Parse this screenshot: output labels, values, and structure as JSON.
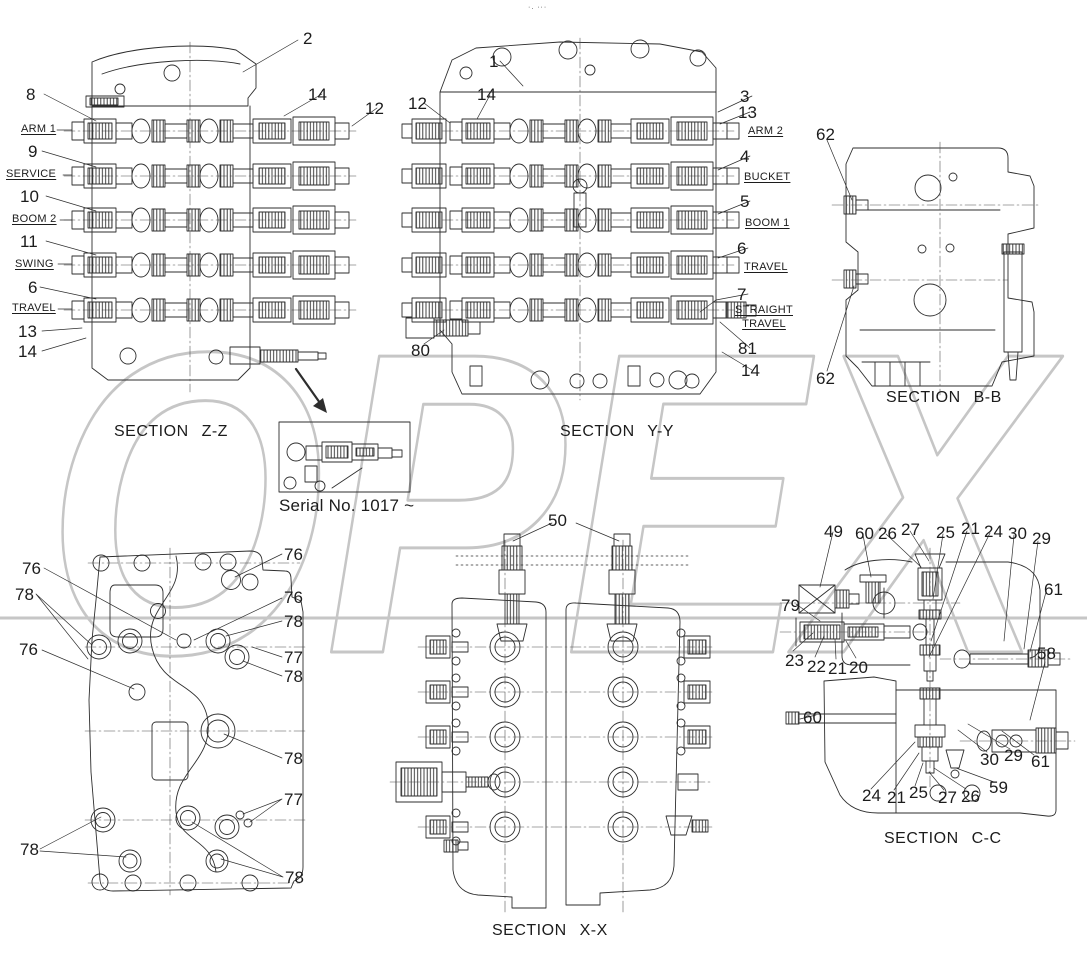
{
  "page": {
    "background": "#ffffff",
    "top_marks": "·. ···"
  },
  "watermark": {
    "text": "OPEX",
    "color": "#c6c6c6"
  },
  "diagram": {
    "sections": [
      {
        "id": "section-zz",
        "title": "SECTION Z-Z",
        "ports": [
          "ARM 1",
          "SERVICE",
          "BOOM 2",
          "SWING",
          "TRAVEL"
        ],
        "callouts": [
          "2",
          "8",
          "9",
          "10",
          "11",
          "6",
          "13",
          "14",
          "12"
        ]
      },
      {
        "id": "section-yy",
        "title": "SECTION Y-Y",
        "ports": [
          "ARM 2",
          "BUCKET",
          "BOOM 1",
          "TRAVEL",
          "STRAIGHT TRAVEL"
        ],
        "callouts": [
          "1",
          "12",
          "14",
          "3",
          "13",
          "4",
          "5",
          "6",
          "7",
          "80",
          "81"
        ]
      },
      {
        "id": "section-bb",
        "title": "SECTION B-B",
        "callouts": [
          "62"
        ]
      },
      {
        "id": "mounting-face-view",
        "title": "",
        "callouts": [
          "76",
          "77",
          "78"
        ]
      },
      {
        "id": "section-xx",
        "title": "SECTION X-X",
        "callouts": [
          "50"
        ]
      },
      {
        "id": "section-cc",
        "title": "SECTION C-C",
        "callouts": [
          "49",
          "60",
          "26",
          "27",
          "25",
          "21",
          "24",
          "30",
          "29",
          "61",
          "79",
          "23",
          "22",
          "20",
          "58",
          "59"
        ]
      }
    ],
    "inset": {
      "caption": "Serial No. 1017 ~"
    }
  },
  "labels": [
    {
      "name": "page-top-marks",
      "text": "·. ···",
      "x": 528,
      "y": 4,
      "cls": "marks"
    },
    {
      "name": "section-title-zz",
      "text": "SECTION Z-Z",
      "x": 114,
      "y": 424,
      "cls": "title"
    },
    {
      "name": "section-title-yy",
      "text": "SECTION Y-Y",
      "x": 560,
      "y": 424,
      "cls": "title"
    },
    {
      "name": "section-title-bb",
      "text": "SECTION B-B",
      "x": 886,
      "y": 390,
      "cls": "title"
    },
    {
      "name": "section-title-xx",
      "text": "SECTION X-X",
      "x": 492,
      "y": 923,
      "cls": "title"
    },
    {
      "name": "section-title-cc",
      "text": "SECTION C-C",
      "x": 884,
      "y": 831,
      "cls": "title"
    },
    {
      "name": "inset-caption",
      "text": "Serial No. 1017 ~",
      "x": 279,
      "y": 497,
      "cls": "caption"
    },
    {
      "name": "callout-2",
      "text": "2",
      "x": 303,
      "y": 30
    },
    {
      "name": "callout-8",
      "text": "8",
      "x": 26,
      "y": 86
    },
    {
      "name": "port-label-arm-1",
      "text": "ARM 1",
      "x": 21,
      "y": 124,
      "cls": "port"
    },
    {
      "name": "callout-9",
      "text": "9",
      "x": 28,
      "y": 143
    },
    {
      "name": "port-label-service",
      "text": "SERVICE",
      "x": 6,
      "y": 169,
      "cls": "port"
    },
    {
      "name": "callout-10",
      "text": "10",
      "x": 20,
      "y": 188
    },
    {
      "name": "port-label-boom-2",
      "text": "BOOM 2",
      "x": 12,
      "y": 214,
      "cls": "port"
    },
    {
      "name": "callout-11",
      "text": "11",
      "x": 20,
      "y": 233
    },
    {
      "name": "port-label-swing",
      "text": "SWING",
      "x": 15,
      "y": 259,
      "cls": "port"
    },
    {
      "name": "callout-6",
      "text": "6",
      "x": 28,
      "y": 279
    },
    {
      "name": "port-label-travel",
      "text": "TRAVEL",
      "x": 12,
      "y": 303,
      "cls": "port"
    },
    {
      "name": "callout-13",
      "text": "13",
      "x": 18,
      "y": 323
    },
    {
      "name": "callout-14",
      "text": "14",
      "x": 18,
      "y": 343
    },
    {
      "name": "callout-14",
      "text": "14",
      "x": 308,
      "y": 86
    },
    {
      "name": "callout-12",
      "text": "12",
      "x": 365,
      "y": 100
    },
    {
      "name": "callout-1",
      "text": "1",
      "x": 489,
      "y": 53
    },
    {
      "name": "callout-12",
      "text": "12",
      "x": 408,
      "y": 95
    },
    {
      "name": "callout-14",
      "text": "14",
      "x": 477,
      "y": 86
    },
    {
      "name": "callout-3",
      "text": "3",
      "x": 740,
      "y": 88
    },
    {
      "name": "callout-13",
      "text": "13",
      "x": 738,
      "y": 104
    },
    {
      "name": "port-label-arm-2",
      "text": "ARM 2",
      "x": 748,
      "y": 126,
      "cls": "port"
    },
    {
      "name": "callout-4",
      "text": "4",
      "x": 740,
      "y": 148
    },
    {
      "name": "port-label-bucket",
      "text": "BUCKET",
      "x": 744,
      "y": 172,
      "cls": "port"
    },
    {
      "name": "callout-5",
      "text": "5",
      "x": 740,
      "y": 193
    },
    {
      "name": "port-label-boom-1",
      "text": "BOOM 1",
      "x": 745,
      "y": 218,
      "cls": "port"
    },
    {
      "name": "callout-6",
      "text": "6",
      "x": 737,
      "y": 240
    },
    {
      "name": "port-label-travel",
      "text": "TRAVEL",
      "x": 744,
      "y": 262,
      "cls": "port"
    },
    {
      "name": "callout-7",
      "text": "7",
      "x": 737,
      "y": 286
    },
    {
      "name": "port-label-straight-travel",
      "text": "STRAIGHT\nTRAVEL",
      "x": 731,
      "y": 303,
      "cls": "port portc"
    },
    {
      "name": "callout-80",
      "text": "80",
      "x": 411,
      "y": 342
    },
    {
      "name": "callout-81",
      "text": "81",
      "x": 738,
      "y": 340
    },
    {
      "name": "callout-14",
      "text": "14",
      "x": 741,
      "y": 362
    },
    {
      "name": "callout-62",
      "text": "62",
      "x": 816,
      "y": 126
    },
    {
      "name": "callout-62",
      "text": "62",
      "x": 816,
      "y": 370
    },
    {
      "name": "callout-76",
      "text": "76",
      "x": 22,
      "y": 560
    },
    {
      "name": "callout-78",
      "text": "78",
      "x": 15,
      "y": 586
    },
    {
      "name": "callout-76",
      "text": "76",
      "x": 19,
      "y": 641
    },
    {
      "name": "callout-76",
      "text": "76",
      "x": 284,
      "y": 546
    },
    {
      "name": "callout-76",
      "text": "76",
      "x": 284,
      "y": 589
    },
    {
      "name": "callout-78",
      "text": "78",
      "x": 284,
      "y": 613
    },
    {
      "name": "callout-77",
      "text": "77",
      "x": 284,
      "y": 649
    },
    {
      "name": "callout-78",
      "text": "78",
      "x": 284,
      "y": 668
    },
    {
      "name": "callout-78",
      "text": "78",
      "x": 284,
      "y": 750
    },
    {
      "name": "callout-77",
      "text": "77",
      "x": 284,
      "y": 791
    },
    {
      "name": "callout-78",
      "text": "78",
      "x": 20,
      "y": 841
    },
    {
      "name": "callout-78",
      "text": "78",
      "x": 285,
      "y": 869
    },
    {
      "name": "callout-50",
      "text": "50",
      "x": 548,
      "y": 512
    },
    {
      "name": "callout-49",
      "text": "49",
      "x": 824,
      "y": 523
    },
    {
      "name": "callout-60",
      "text": "60",
      "x": 855,
      "y": 525
    },
    {
      "name": "callout-26",
      "text": "26",
      "x": 878,
      "y": 525
    },
    {
      "name": "callout-27",
      "text": "27",
      "x": 901,
      "y": 521
    },
    {
      "name": "callout-25",
      "text": "25",
      "x": 936,
      "y": 524
    },
    {
      "name": "callout-21",
      "text": "21",
      "x": 961,
      "y": 520
    },
    {
      "name": "callout-24",
      "text": "24",
      "x": 984,
      "y": 523
    },
    {
      "name": "callout-30",
      "text": "30",
      "x": 1008,
      "y": 525
    },
    {
      "name": "callout-29",
      "text": "29",
      "x": 1032,
      "y": 530
    },
    {
      "name": "callout-61",
      "text": "61",
      "x": 1044,
      "y": 581
    },
    {
      "name": "callout-79",
      "text": "79",
      "x": 781,
      "y": 597
    },
    {
      "name": "callout-23",
      "text": "23",
      "x": 785,
      "y": 652
    },
    {
      "name": "callout-22",
      "text": "22",
      "x": 807,
      "y": 658
    },
    {
      "name": "callout-21",
      "text": "21",
      "x": 828,
      "y": 660
    },
    {
      "name": "callout-20",
      "text": "20",
      "x": 849,
      "y": 659
    },
    {
      "name": "callout-58",
      "text": "58",
      "x": 1037,
      "y": 645
    },
    {
      "name": "callout-60",
      "text": "60",
      "x": 803,
      "y": 709
    },
    {
      "name": "callout-30",
      "text": "30",
      "x": 980,
      "y": 751
    },
    {
      "name": "callout-29",
      "text": "29",
      "x": 1004,
      "y": 747
    },
    {
      "name": "callout-61",
      "text": "61",
      "x": 1031,
      "y": 753
    },
    {
      "name": "callout-24",
      "text": "24",
      "x": 862,
      "y": 787
    },
    {
      "name": "callout-21",
      "text": "21",
      "x": 887,
      "y": 789
    },
    {
      "name": "callout-25",
      "text": "25",
      "x": 909,
      "y": 784
    },
    {
      "name": "callout-27",
      "text": "27",
      "x": 938,
      "y": 789
    },
    {
      "name": "callout-26",
      "text": "26",
      "x": 961,
      "y": 788
    },
    {
      "name": "callout-59",
      "text": "59",
      "x": 989,
      "y": 779
    }
  ]
}
